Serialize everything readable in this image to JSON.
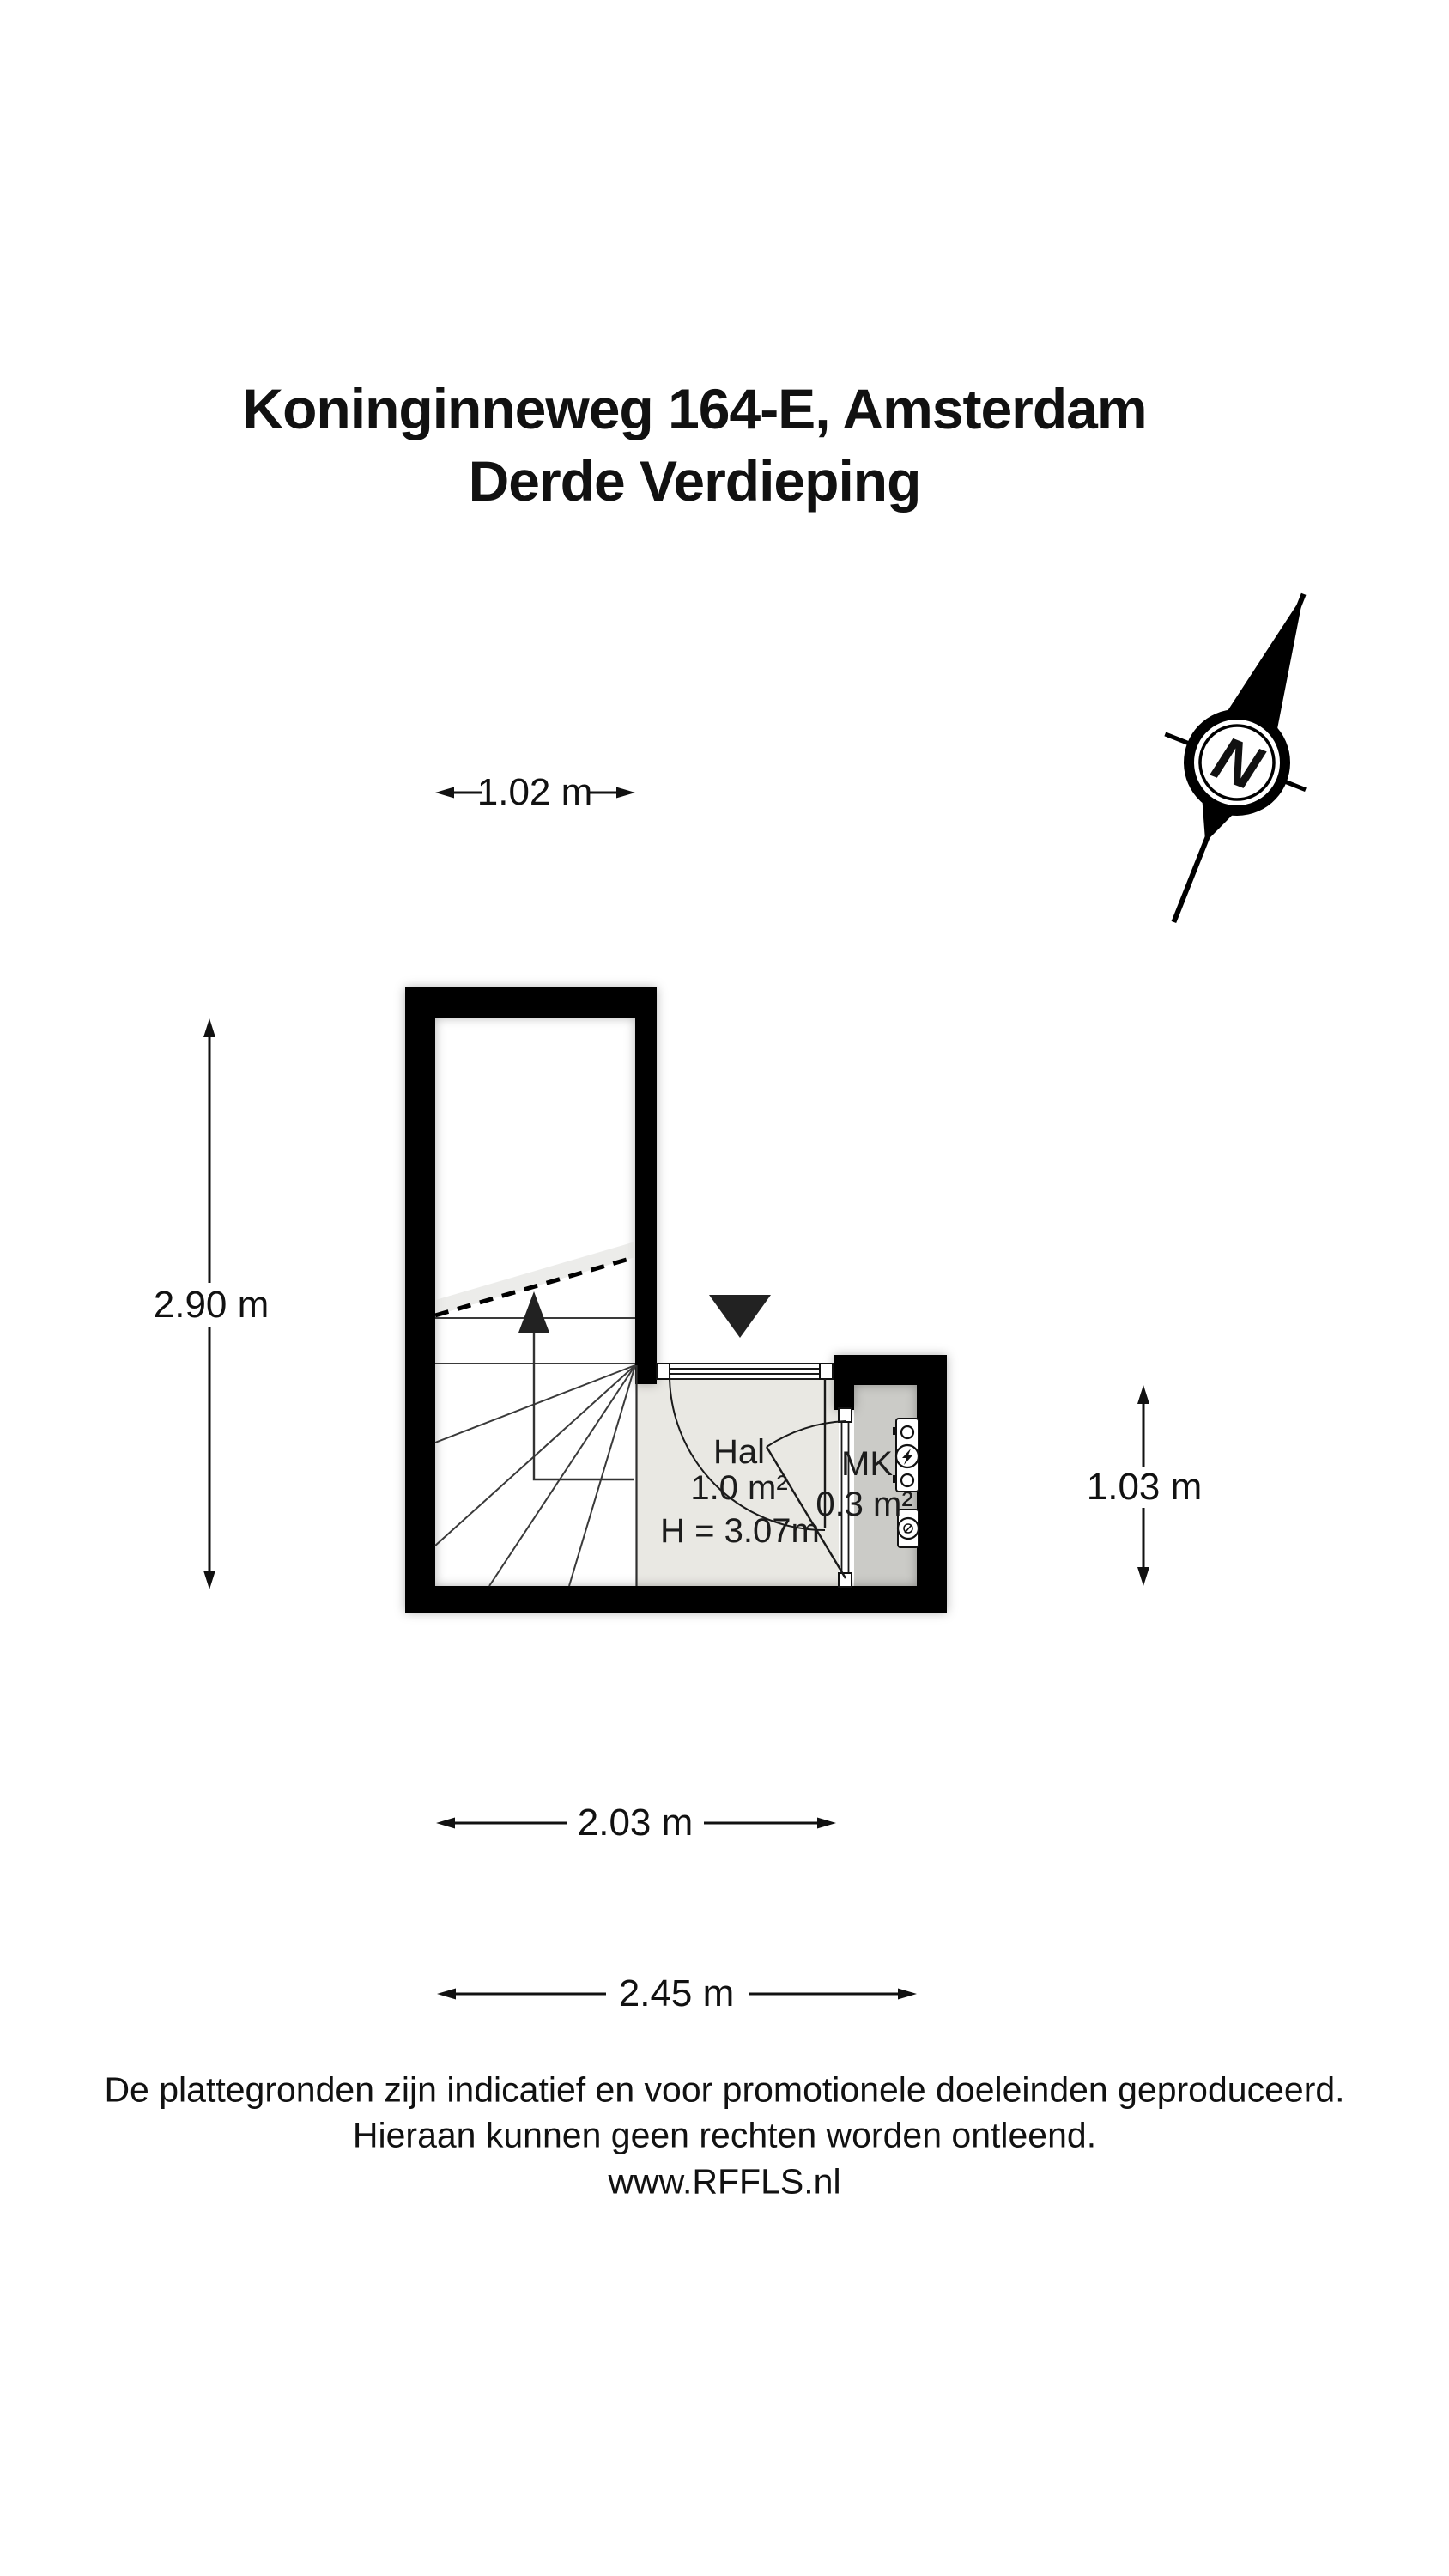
{
  "title": {
    "line1": "Koninginneweg 164-E, Amsterdam",
    "line2": "Derde Verdieping"
  },
  "compass": {
    "label": "N",
    "icon": "north-indicator-icon"
  },
  "dimensions": {
    "top_width": "1.02 m",
    "left_height": "2.90 m",
    "right_height": "1.03 m",
    "bottom_inner_width": "2.03 m",
    "bottom_outer_width": "2.45 m"
  },
  "rooms": {
    "hal": {
      "name": "Hal",
      "area": "1.0 m²",
      "ceiling_height": "H = 3.07m"
    },
    "mk": {
      "name": "MK",
      "area": "0.3 m²"
    }
  },
  "plan_icons": {
    "entrance": "entrance-arrow-icon",
    "stairs_direction": "stairs-up-arrow-icon",
    "electric_meter": "electric-meter-icon",
    "water_meter": "water-meter-icon"
  },
  "footer": {
    "line1": "De plattegronden zijn indicatief en voor promotionele doeleinden geproduceerd.",
    "line2": "Hieraan kunnen geen rechten worden ontleend.",
    "line3": "www.RFFLS.nl"
  },
  "colors": {
    "wall": "#000000",
    "hal_floor": "#e9e8e3",
    "mk_floor": "#cbcbc7",
    "line": "#3a3a3a",
    "text": "#111111"
  }
}
